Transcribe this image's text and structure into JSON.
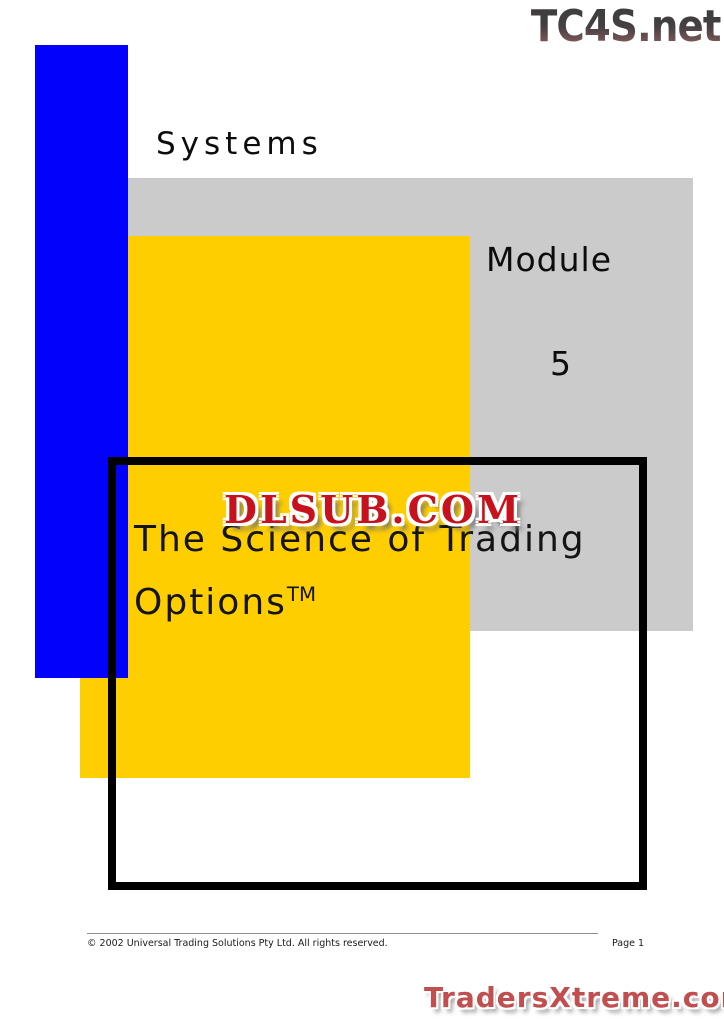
{
  "headings": {
    "systems": "Systems",
    "module": "Module",
    "module_number": "5"
  },
  "title": {
    "line1": "The Science of Trading",
    "line2": "Options",
    "trademark": "TM"
  },
  "watermarks": {
    "top_right": "TC4S.net",
    "center": "DLSUB.COM",
    "bottom_right": "TradersXtreme.com"
  },
  "footer": {
    "copyright": "© 2002 Universal Trading Solutions Pty Ltd. All rights reserved.",
    "page_number": "Page 1"
  },
  "colors": {
    "accent_blue": "#0101FC",
    "accent_yellow": "#FFCE00",
    "accent_gray": "#CBCBCB",
    "frame_black": "#000000",
    "watermark_red": "#C6121C",
    "watermark_soft_red": "#C14F4F"
  }
}
